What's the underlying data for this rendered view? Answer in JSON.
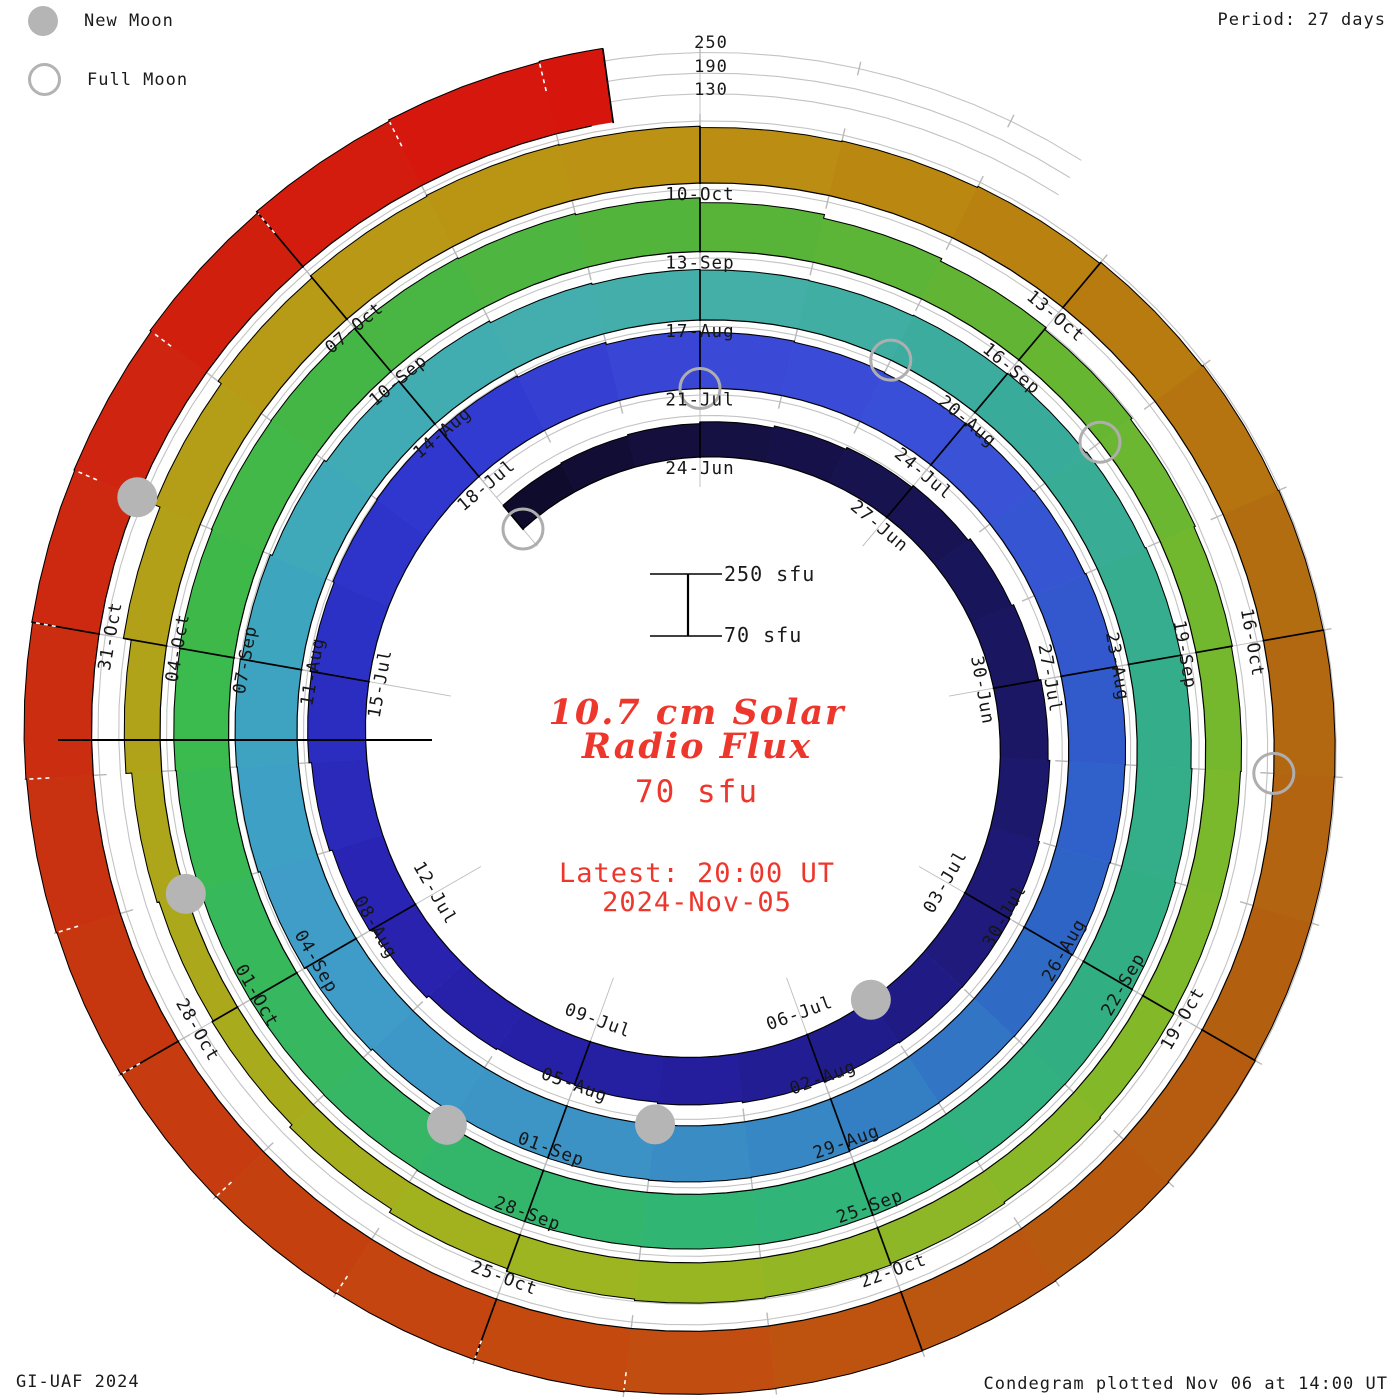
{
  "header": {
    "period_label": "Period: 27 days"
  },
  "legend": {
    "new_moon": "New Moon",
    "full_moon": "Full Moon"
  },
  "footer": {
    "left": "GI-UAF 2024",
    "right": "Condegram plotted Nov 06 at 14:00 UT"
  },
  "center": {
    "title_line1": "10.7 cm Solar",
    "title_line2": "Radio Flux",
    "baseline_value": "70 sfu",
    "latest_line1": "Latest: 20:00 UT",
    "latest_line2": "2024-Nov-05"
  },
  "scale": {
    "top_labels": [
      "250",
      "190",
      "130"
    ],
    "bar_top": "250 sfu",
    "bar_bottom": "70 sfu",
    "min": 70,
    "max": 250,
    "gridlines": [
      130,
      190,
      250
    ],
    "units": "sfu"
  },
  "chart_data": {
    "type": "bar",
    "variant": "condegram-spiral",
    "title": "10.7 cm Solar Radio Flux",
    "period_days": 27,
    "start_date": "2024-06-21",
    "end_date": "2024-11-05",
    "top_anchor_date": "2024-06-24",
    "clip_level": 252,
    "values": [
      160,
      163,
      167,
      172,
      178,
      184,
      190,
      197,
      203,
      209,
      214,
      218,
      221,
      220,
      217,
      213,
      208,
      204,
      202,
      206,
      214,
      223,
      231,
      238,
      243,
      247,
      249,
      247,
      243,
      237,
      232,
      229,
      227,
      228,
      230,
      233,
      235,
      234,
      232,
      230,
      229,
      230,
      232,
      233,
      231,
      230,
      232,
      237,
      243,
      248,
      250,
      246,
      240,
      233,
      227,
      221,
      217,
      215,
      214,
      216,
      218,
      221,
      224,
      227,
      230,
      233,
      234,
      233,
      231,
      230,
      229,
      228,
      228,
      227,
      226,
      226,
      227,
      229,
      231,
      233,
      234,
      233,
      230,
      226,
      212,
      201,
      193,
      186,
      181,
      177,
      174,
      172,
      172,
      174,
      177,
      181,
      185,
      187,
      183,
      175,
      164,
      155,
      151,
      157,
      174,
      197,
      215,
      227,
      234,
      237,
      235,
      231,
      233,
      237,
      241,
      244,
      246,
      247,
      246,
      246,
      248,
      250,
      251,
      252,
      253,
      255,
      257,
      259,
      260,
      262,
      264,
      266,
      268,
      270,
      274,
      279,
      283,
      286
    ],
    "tick_labels": [
      "24-Jun",
      "27-Jun",
      "30-Jun",
      "03-Jul",
      "06-Jul",
      "09-Jul",
      "12-Jul",
      "15-Jul",
      "18-Jul",
      "21-Jul",
      "24-Jul",
      "27-Jul",
      "30-Jul",
      "02-Aug",
      "05-Aug",
      "08-Aug",
      "11-Aug",
      "14-Aug",
      "17-Aug",
      "20-Aug",
      "23-Aug",
      "26-Aug",
      "29-Aug",
      "01-Sep",
      "04-Sep",
      "07-Sep",
      "10-Sep",
      "13-Sep",
      "16-Sep",
      "19-Sep",
      "22-Sep",
      "25-Sep",
      "28-Sep",
      "01-Oct",
      "04-Oct",
      "07-Oct",
      "10-Oct",
      "13-Oct",
      "16-Oct",
      "19-Oct",
      "22-Oct",
      "25-Oct",
      "28-Oct",
      "31-Oct"
    ],
    "new_moons": [
      "2024-07-05",
      "2024-08-04",
      "2024-09-02",
      "2024-10-02",
      "2024-11-01"
    ],
    "full_moons": [
      "2024-06-21",
      "2024-07-21",
      "2024-08-19",
      "2024-09-17",
      "2024-10-17"
    ],
    "new_moon_days": [
      14,
      44,
      73,
      103,
      133
    ],
    "full_moon_days": [
      0,
      30,
      59,
      88,
      118
    ],
    "color_stops": [
      [
        0,
        "#0d0a28"
      ],
      [
        3,
        "#151040"
      ],
      [
        10,
        "#1b1768"
      ],
      [
        17,
        "#251fa0"
      ],
      [
        21,
        "#2822b0"
      ],
      [
        24,
        "#2b2fc4"
      ],
      [
        27,
        "#3038d0"
      ],
      [
        30,
        "#3a47d6"
      ],
      [
        33,
        "#3a50d8"
      ],
      [
        36,
        "#3259cc"
      ],
      [
        39,
        "#2e66c6"
      ],
      [
        42,
        "#3584c2"
      ],
      [
        45,
        "#3d93c6"
      ],
      [
        48,
        "#3f9cc8"
      ],
      [
        51,
        "#3da4c0"
      ],
      [
        54,
        "#40acb2"
      ],
      [
        57,
        "#45b0a8"
      ],
      [
        60,
        "#3aab9d"
      ],
      [
        63,
        "#35ad8c"
      ],
      [
        66,
        "#31ae84"
      ],
      [
        69,
        "#2fb47a"
      ],
      [
        72,
        "#33b66c"
      ],
      [
        75,
        "#36b75e"
      ],
      [
        78,
        "#3cba4a"
      ],
      [
        81,
        "#46b545"
      ],
      [
        84,
        "#55b43a"
      ],
      [
        87,
        "#64b533"
      ],
      [
        90,
        "#74b82e"
      ],
      [
        93,
        "#80b82a"
      ],
      [
        96,
        "#90b725"
      ],
      [
        99,
        "#a0b41f"
      ],
      [
        102,
        "#aaaa1b"
      ],
      [
        105,
        "#b1a219"
      ],
      [
        108,
        "#b89a15"
      ],
      [
        111,
        "#bb9013"
      ],
      [
        114,
        "#b87e0f"
      ],
      [
        117,
        "#b16a11"
      ],
      [
        120,
        "#b35d10"
      ],
      [
        123,
        "#bd5510"
      ],
      [
        126,
        "#c4470f"
      ],
      [
        129,
        "#c6390f"
      ],
      [
        132,
        "#cc2a10"
      ],
      [
        135,
        "#d21d0e"
      ],
      [
        137,
        "#d6150c"
      ]
    ]
  }
}
